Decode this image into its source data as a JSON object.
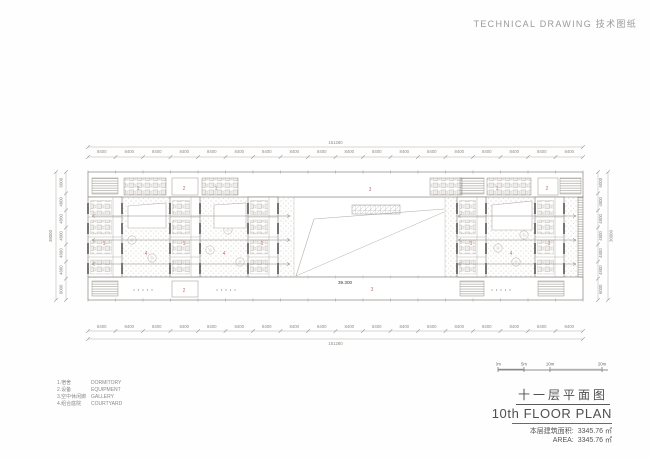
{
  "header": {
    "title": "TECHNICAL DRAWING 技术图纸"
  },
  "legend": {
    "items": [
      {
        "zh": "1.宿舍",
        "en": "DORMITORY"
      },
      {
        "zh": "2.设备",
        "en": "EQUIPMENT"
      },
      {
        "zh": "3.空中休闲廊",
        "en": "GALLERY"
      },
      {
        "zh": "4.组合庭院",
        "en": "COURTYARD"
      }
    ]
  },
  "scalebar": {
    "labels": [
      "0m",
      "5m",
      "10m",
      "20m"
    ]
  },
  "titleblock": {
    "title_zh": "十一层平面图",
    "title_en": "10th FLOOR PLAN",
    "area_rows": [
      {
        "label": "本层建筑面积:",
        "value": "3345.76 ㎡"
      },
      {
        "label": "AREA:",
        "value": "3345.76 ㎡"
      }
    ]
  },
  "dimensions": {
    "top": {
      "total": "151280",
      "bay": "8400",
      "bay_count": 18
    },
    "bottom": {
      "total": "151280",
      "bay": "8400",
      "bay_count": 18
    },
    "left": {
      "total": "38000",
      "segments": [
        "6000",
        "4800",
        "4800",
        "4800",
        "4800",
        "4800",
        "6000"
      ]
    },
    "right": {
      "total": "36000",
      "segments": [
        "6000",
        "4800",
        "4800",
        "4800",
        "4800",
        "4800",
        "6000"
      ]
    }
  },
  "plan": {
    "level_label": "39.300",
    "labels": [
      {
        "text": "1",
        "x": 138,
        "y": 190
      },
      {
        "text": "2",
        "x": 184,
        "y": 190
      },
      {
        "text": "1",
        "x": 216,
        "y": 190
      },
      {
        "text": "3",
        "x": 370,
        "y": 191
      },
      {
        "text": "1",
        "x": 497,
        "y": 190
      },
      {
        "text": "2",
        "x": 547,
        "y": 190
      },
      {
        "text": "1",
        "x": 104,
        "y": 245
      },
      {
        "text": "1",
        "x": 184,
        "y": 245
      },
      {
        "text": "1",
        "x": 262,
        "y": 245
      },
      {
        "text": "1",
        "x": 471,
        "y": 245
      },
      {
        "text": "1",
        "x": 549,
        "y": 245
      },
      {
        "text": "4",
        "x": 146,
        "y": 255
      },
      {
        "text": "4",
        "x": 224,
        "y": 255
      },
      {
        "text": "4",
        "x": 511,
        "y": 255
      },
      {
        "text": "2",
        "x": 184,
        "y": 292
      },
      {
        "text": "3",
        "x": 372,
        "y": 291
      }
    ]
  },
  "colors": {
    "red_label": "#bd7672",
    "dim_text": "#8f8b85",
    "line_light": "#b5b0aa",
    "line_mid": "#8a8680",
    "line_dark": "#3a3a3a"
  }
}
